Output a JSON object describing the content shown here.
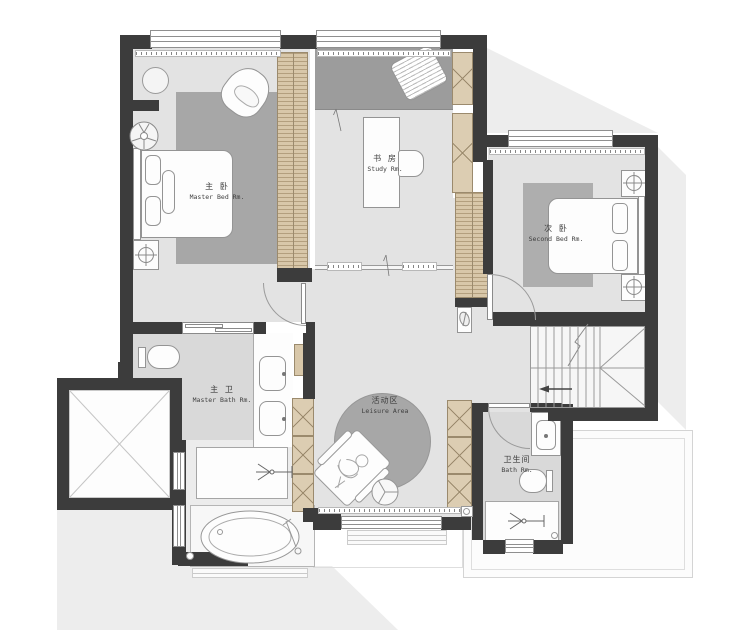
{
  "rooms": {
    "master_bed": {
      "zh": "主 卧",
      "en": "Master Bed Rm."
    },
    "study": {
      "zh": "书 房",
      "en": "Study Rm."
    },
    "second_bed": {
      "zh": "次 卧",
      "en": "Second Bed Rm."
    },
    "master_bath": {
      "zh": "主 卫",
      "en": "Master Bath Rm."
    },
    "bath": {
      "zh": "卫生间",
      "en": "Bath Rm."
    },
    "leisure": {
      "zh": "活动区",
      "en": "Leisure Area"
    }
  },
  "colors": {
    "wall": "#3c3c3c",
    "floor": "#e3e3e3",
    "floor_dark": "#d9d9d9",
    "platform": "#9c9c9c",
    "rug": "#a7a7a7",
    "rug_light": "#aeaeae",
    "wardrobe": "#d8c7a9",
    "cabinet_line": "#9b8a6d",
    "fixture": "#fdfdfd",
    "line": "#8f8f8f",
    "shadow": "#ededed",
    "text": "#3f3f3f"
  },
  "icons": {
    "ceiling_fan": "fan-icon",
    "crosshair_decor": "crosshair-icon",
    "shower_head": "shower-icon",
    "stair_direction": "arrow-left-icon",
    "elevator_cross": "elevator-x-icon"
  }
}
